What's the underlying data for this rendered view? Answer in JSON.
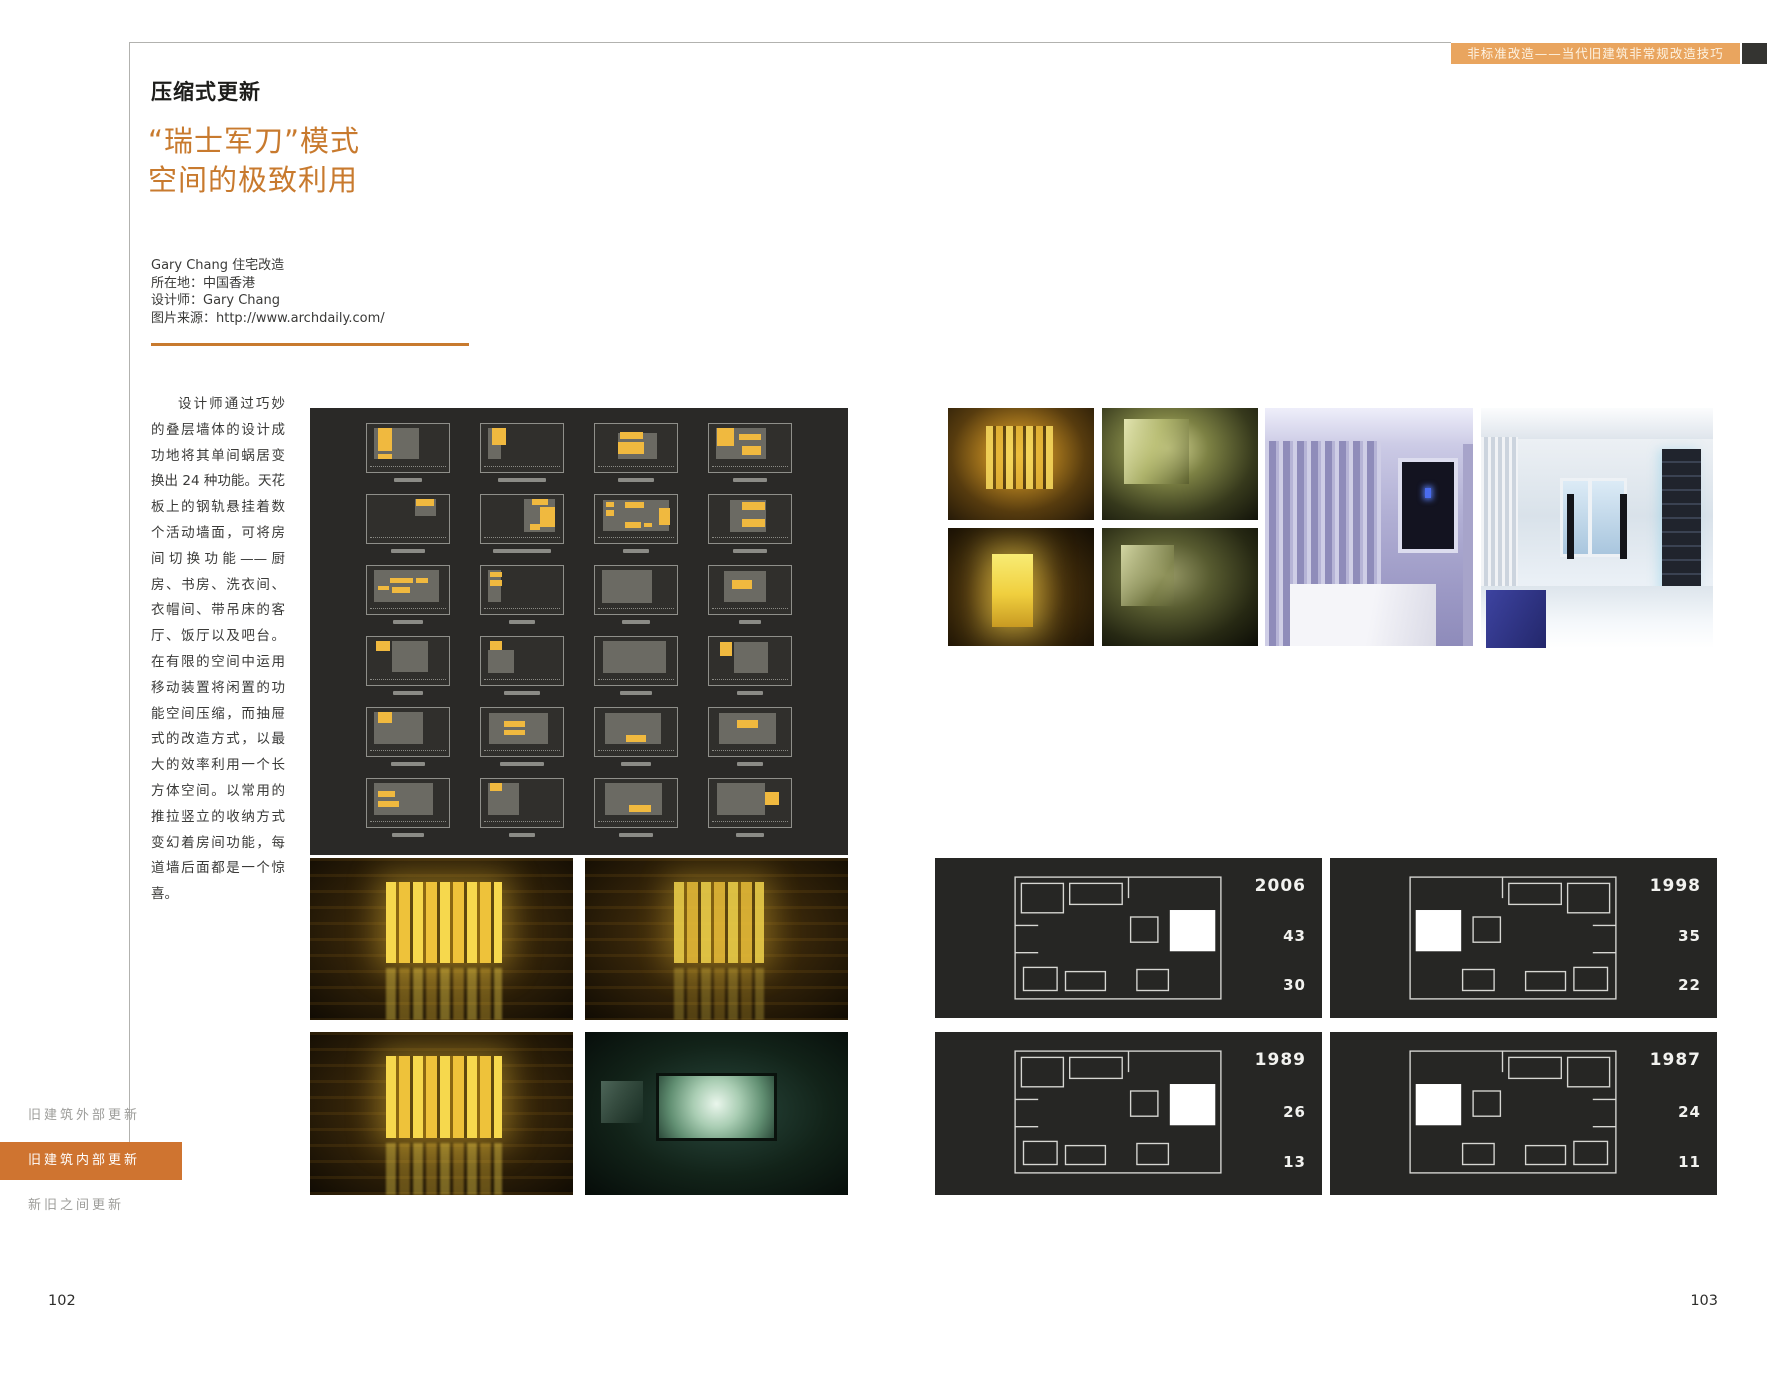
{
  "header": {
    "title": "非标准改造——当代旧建筑非常规改造技巧"
  },
  "article": {
    "section_title": "压缩式更新",
    "title_line1": "“瑞士军刀”模式",
    "title_line2": "空间的极致利用",
    "info_lines": [
      "Gary Chang 住宅改造",
      "所在地：中国香港",
      "设计师：Gary Chang",
      "图片来源：http://www.archdaily.com/"
    ],
    "body": "设计师通过巧妙的叠层墙体的设计成功地将其单间蜗居变换出 24 种功能。天花板上的钢轨悬挂着数个活动墙面，可将房间切换功能——厨房、书房、洗衣间、衣帽间、带吊床的客厅、饭厅以及吧台。在有限的空间中运用移动装置将闲置的功能空间压缩，而抽屉式的改造方式，以最大的效率利用一个长方体空间。以常用的推拉竖立的收纳方式变幻着房间功能，每道墙后面都是一个惊喜。"
  },
  "sidebar": {
    "items": [
      {
        "label": "旧建筑外部更新",
        "active": false
      },
      {
        "label": "旧建筑内部更新",
        "active": true
      },
      {
        "label": "新旧之间更新",
        "active": false
      }
    ]
  },
  "page_numbers": {
    "left": "102",
    "right": "103"
  },
  "year_panels": [
    {
      "year": "2006",
      "values": [
        "43",
        "30"
      ]
    },
    {
      "year": "1998",
      "values": [
        "35",
        "22"
      ]
    },
    {
      "year": "1989",
      "values": [
        "26",
        "13"
      ]
    },
    {
      "year": "1987",
      "values": [
        "24",
        "11"
      ]
    }
  ],
  "photos": {
    "top_right": [
      "amber-interior",
      "olive-interior",
      "amber-lit-doorway",
      "olive-interior-dark",
      "purple-bedroom-curtains",
      "white-living-room"
    ],
    "bottom_left": [
      "amber-bath-panels",
      "amber-bath-dim",
      "amber-bath-reflection",
      "tv-screening-room"
    ]
  },
  "colors": {
    "accent_orange": "#c87a2e",
    "header_orange": "#e9a55f",
    "sidebar_orange": "#cf7430",
    "panel_bg": "#2a2927",
    "plan_yellow": "#f0b93f",
    "plan_gray": "#75746d"
  },
  "plan_matrix": {
    "rows": 6,
    "cols": 4,
    "cells": [
      {
        "g": [
          [
            8,
            8,
            55,
            64
          ]
        ],
        "y": [
          [
            13,
            8,
            17,
            48
          ],
          [
            13,
            62,
            17,
            10
          ]
        ],
        "c": 34
      },
      {
        "g": [
          [
            8,
            8,
            16,
            64
          ]
        ],
        "y": [
          [
            13,
            8,
            17,
            36
          ]
        ],
        "c": 58
      },
      {
        "g": [
          [
            28,
            18,
            48,
            54
          ]
        ],
        "y": [
          [
            30,
            16,
            28,
            16
          ],
          [
            28,
            38,
            32,
            24
          ]
        ],
        "c": 44
      },
      {
        "g": [
          [
            8,
            8,
            62,
            64
          ]
        ],
        "y": [
          [
            10,
            8,
            20,
            38
          ],
          [
            36,
            20,
            28,
            14
          ],
          [
            40,
            46,
            24,
            18
          ]
        ],
        "c": 40
      },
      {
        "g": [
          [
            58,
            8,
            26,
            36
          ]
        ],
        "y": [
          [
            60,
            8,
            22,
            14
          ]
        ],
        "c": 40
      },
      {
        "g": [
          [
            52,
            8,
            38,
            70
          ]
        ],
        "y": [
          [
            62,
            8,
            20,
            12
          ],
          [
            72,
            26,
            18,
            40
          ],
          [
            60,
            60,
            12,
            12
          ]
        ],
        "c": 70
      },
      {
        "g": [
          [
            10,
            10,
            80,
            66
          ]
        ],
        "y": [
          [
            14,
            14,
            9,
            12
          ],
          [
            14,
            32,
            9,
            12
          ],
          [
            36,
            14,
            24,
            14
          ],
          [
            36,
            56,
            20,
            12
          ],
          [
            60,
            58,
            9,
            9
          ],
          [
            78,
            28,
            14,
            34
          ]
        ],
        "c": 30
      },
      {
        "g": [
          [
            26,
            10,
            44,
            68
          ]
        ],
        "y": [
          [
            40,
            14,
            28,
            18
          ],
          [
            40,
            50,
            28,
            16
          ]
        ],
        "c": 40
      },
      {
        "g": [
          [
            8,
            8,
            80,
            66
          ]
        ],
        "y": [
          [
            28,
            24,
            28,
            11
          ],
          [
            14,
            42,
            13,
            9
          ],
          [
            30,
            44,
            22,
            12
          ],
          [
            60,
            26,
            15,
            10
          ]
        ],
        "c": 36
      },
      {
        "g": [
          [
            8,
            8,
            16,
            66
          ]
        ],
        "y": [
          [
            11,
            12,
            15,
            11
          ],
          [
            11,
            30,
            15,
            11
          ]
        ],
        "c": 30
      },
      {
        "g": [
          [
            8,
            8,
            62,
            70
          ]
        ],
        "y": [],
        "c": 34
      },
      {
        "g": [
          [
            18,
            10,
            52,
            66
          ]
        ],
        "y": [
          [
            28,
            30,
            24,
            17
          ]
        ],
        "c": 26
      },
      {
        "g": [
          [
            30,
            8,
            44,
            64
          ]
        ],
        "y": [
          [
            11,
            8,
            17,
            22
          ]
        ],
        "c": 36
      },
      {
        "g": [
          [
            8,
            28,
            32,
            46
          ]
        ],
        "y": [
          [
            11,
            8,
            15,
            19
          ]
        ],
        "c": 44
      },
      {
        "g": [
          [
            10,
            8,
            76,
            66
          ]
        ],
        "y": [],
        "c": 38
      },
      {
        "g": [
          [
            30,
            10,
            42,
            64
          ]
        ],
        "y": [
          [
            13,
            10,
            15,
            30
          ]
        ],
        "c": 32
      },
      {
        "g": [
          [
            8,
            8,
            60,
            66
          ]
        ],
        "y": [
          [
            13,
            8,
            17,
            24
          ]
        ],
        "c": 40
      },
      {
        "g": [
          [
            10,
            10,
            72,
            64
          ]
        ],
        "y": [
          [
            28,
            28,
            26,
            11
          ],
          [
            28,
            46,
            26,
            11
          ]
        ],
        "c": 52
      },
      {
        "g": [
          [
            12,
            10,
            68,
            64
          ]
        ],
        "y": [
          [
            38,
            56,
            24,
            14
          ]
        ],
        "c": 36
      },
      {
        "g": [
          [
            12,
            10,
            70,
            64
          ]
        ],
        "y": [
          [
            34,
            24,
            26,
            18
          ]
        ],
        "c": 30
      },
      {
        "g": [
          [
            8,
            8,
            72,
            66
          ]
        ],
        "y": [
          [
            13,
            26,
            21,
            12
          ],
          [
            13,
            46,
            26,
            12
          ]
        ],
        "c": 38
      },
      {
        "g": [
          [
            8,
            8,
            38,
            68
          ]
        ],
        "y": [
          [
            11,
            8,
            15,
            17
          ]
        ],
        "c": 30
      },
      {
        "g": [
          [
            12,
            8,
            70,
            66
          ]
        ],
        "y": [
          [
            42,
            54,
            26,
            14
          ]
        ],
        "c": 40
      },
      {
        "g": [
          [
            10,
            8,
            58,
            66
          ]
        ],
        "y": [
          [
            68,
            28,
            17,
            26
          ]
        ],
        "c": 34
      }
    ]
  }
}
